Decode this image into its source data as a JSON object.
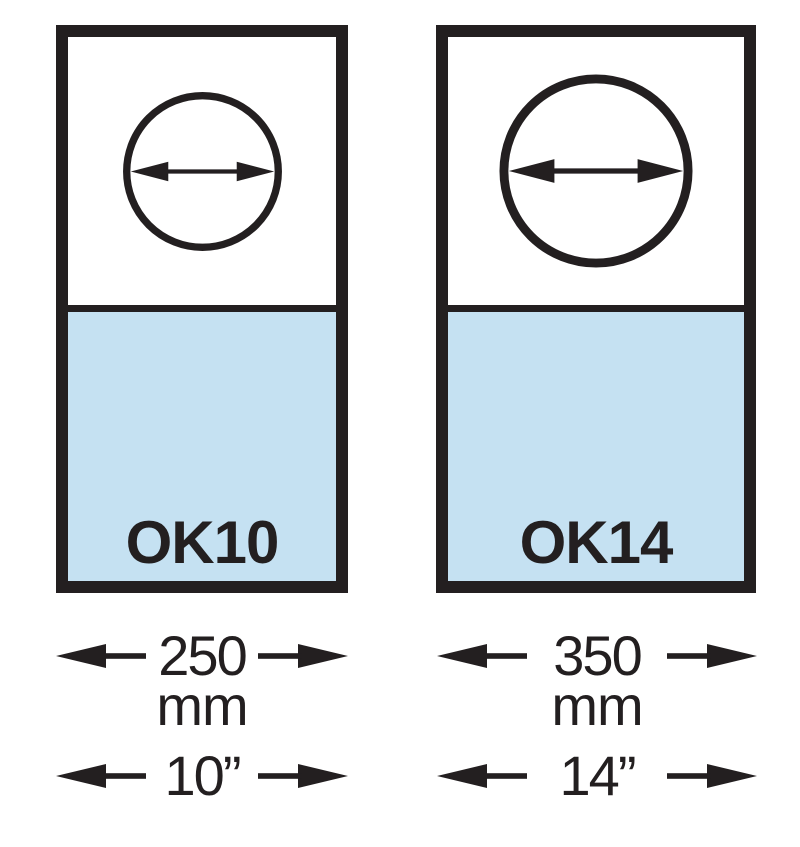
{
  "colors": {
    "outline": "#231f20",
    "panel_fill_top": "#ffffff",
    "panel_fill_bottom": "#c5e1f2"
  },
  "icons": {
    "diameter": "circle-with-horizontal-double-arrow",
    "dimension_left": "solid-arrowhead-pointing-left",
    "dimension_right": "solid-arrowhead-pointing-right"
  },
  "panels": [
    {
      "label": "OK10",
      "width_mm": "250",
      "unit_mm": "mm",
      "width_inch": "10”"
    },
    {
      "label": "OK14",
      "width_mm": "350",
      "unit_mm": "mm",
      "width_inch": "14”"
    }
  ]
}
